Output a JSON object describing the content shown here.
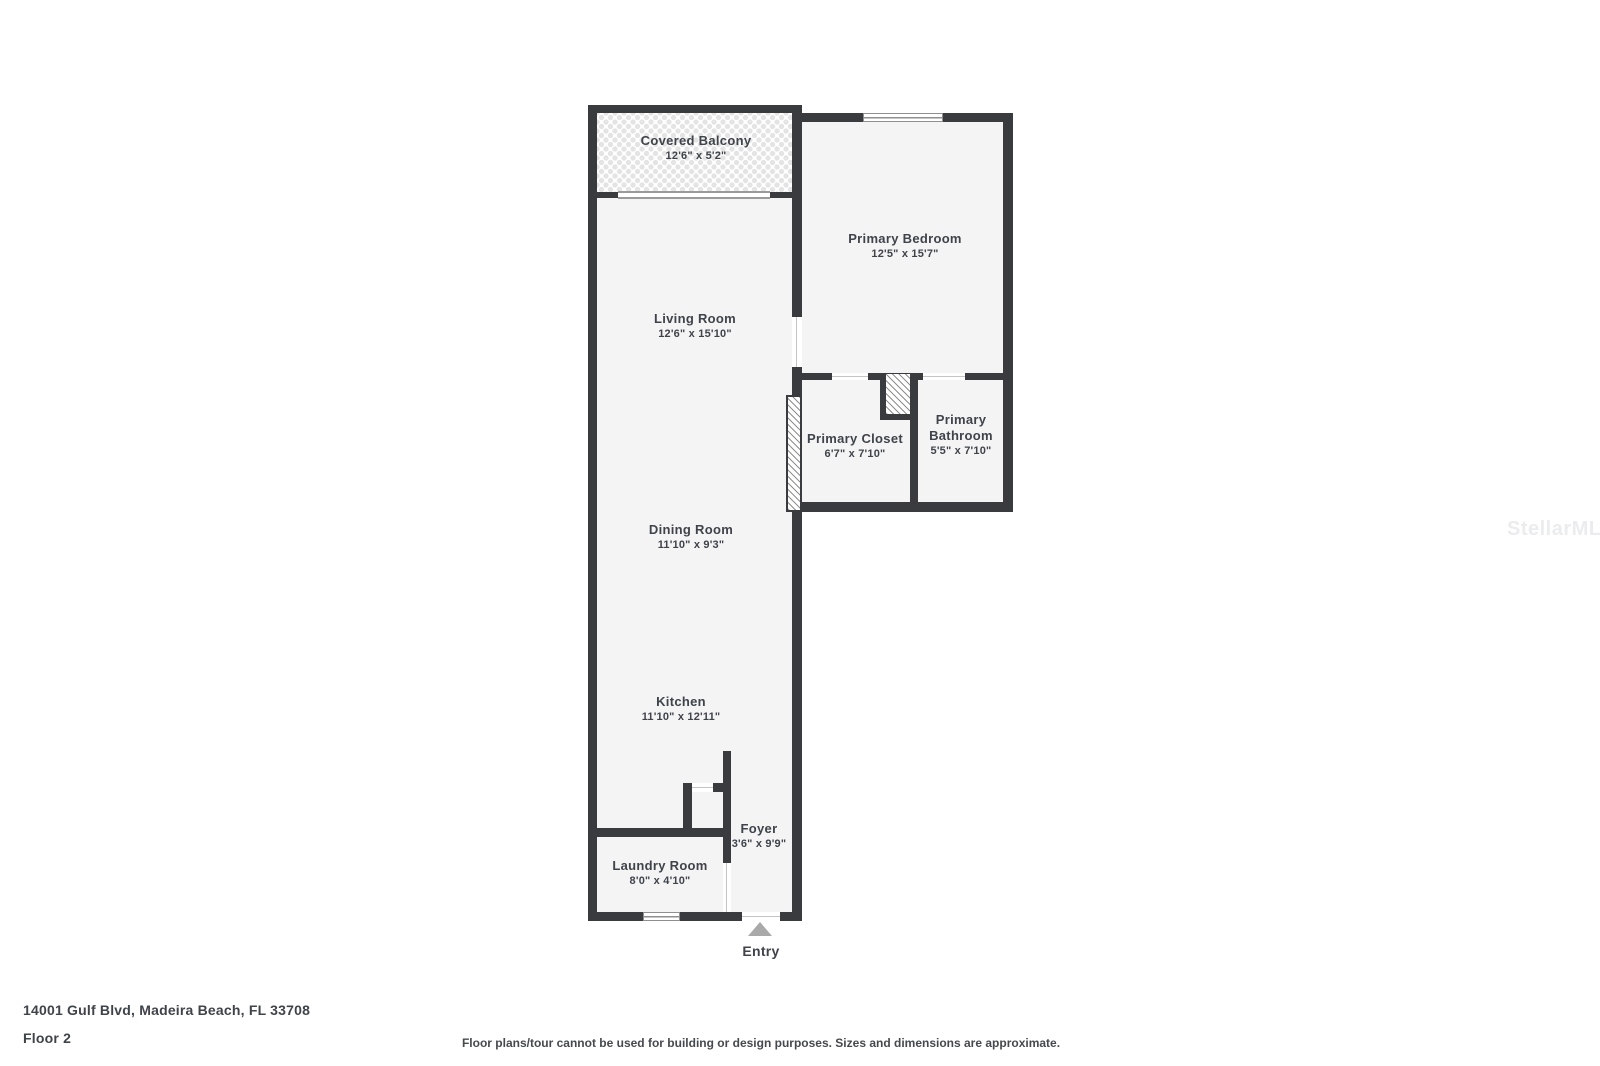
{
  "watermark": {
    "text": "StellarMLS"
  },
  "footer": {
    "address": "14001 Gulf Blvd, Madeira Beach, FL 33708",
    "floor": "Floor 2",
    "disclaimer": "Floor plans/tour cannot be used for building or design purposes. Sizes and dimensions are approximate."
  },
  "entry": {
    "label": "Entry"
  },
  "rooms": [
    {
      "id": "covered-balcony",
      "name": "Covered Balcony",
      "dims": "12'6\" x 5'2\""
    },
    {
      "id": "living-room",
      "name": "Living Room",
      "dims": "12'6\" x 15'10\""
    },
    {
      "id": "dining-room",
      "name": "Dining Room",
      "dims": "11'10\" x 9'3\""
    },
    {
      "id": "kitchen",
      "name": "Kitchen",
      "dims": "11'10\" x 12'11\""
    },
    {
      "id": "foyer",
      "name": "Foyer",
      "dims": "3'6\" x 9'9\""
    },
    {
      "id": "laundry-room",
      "name": "Laundry Room",
      "dims": "8'0\" x 4'10\""
    },
    {
      "id": "primary-bedroom",
      "name": "Primary Bedroom",
      "dims": "12'5\" x 15'7\""
    },
    {
      "id": "primary-closet",
      "name": "Primary Closet",
      "dims": "6'7\" x 7'10\""
    },
    {
      "id": "primary-bathroom",
      "name": "Primary Bathroom",
      "dims": "5'5\" x 7'10\""
    }
  ],
  "colors": {
    "wall": "#3a3b3f",
    "room_fill": "#f4f4f5",
    "text": "#3f434a",
    "window_line": "#8f8f8f",
    "entry_arrow": "#a9a9a9",
    "watermark": "#ebecee"
  }
}
